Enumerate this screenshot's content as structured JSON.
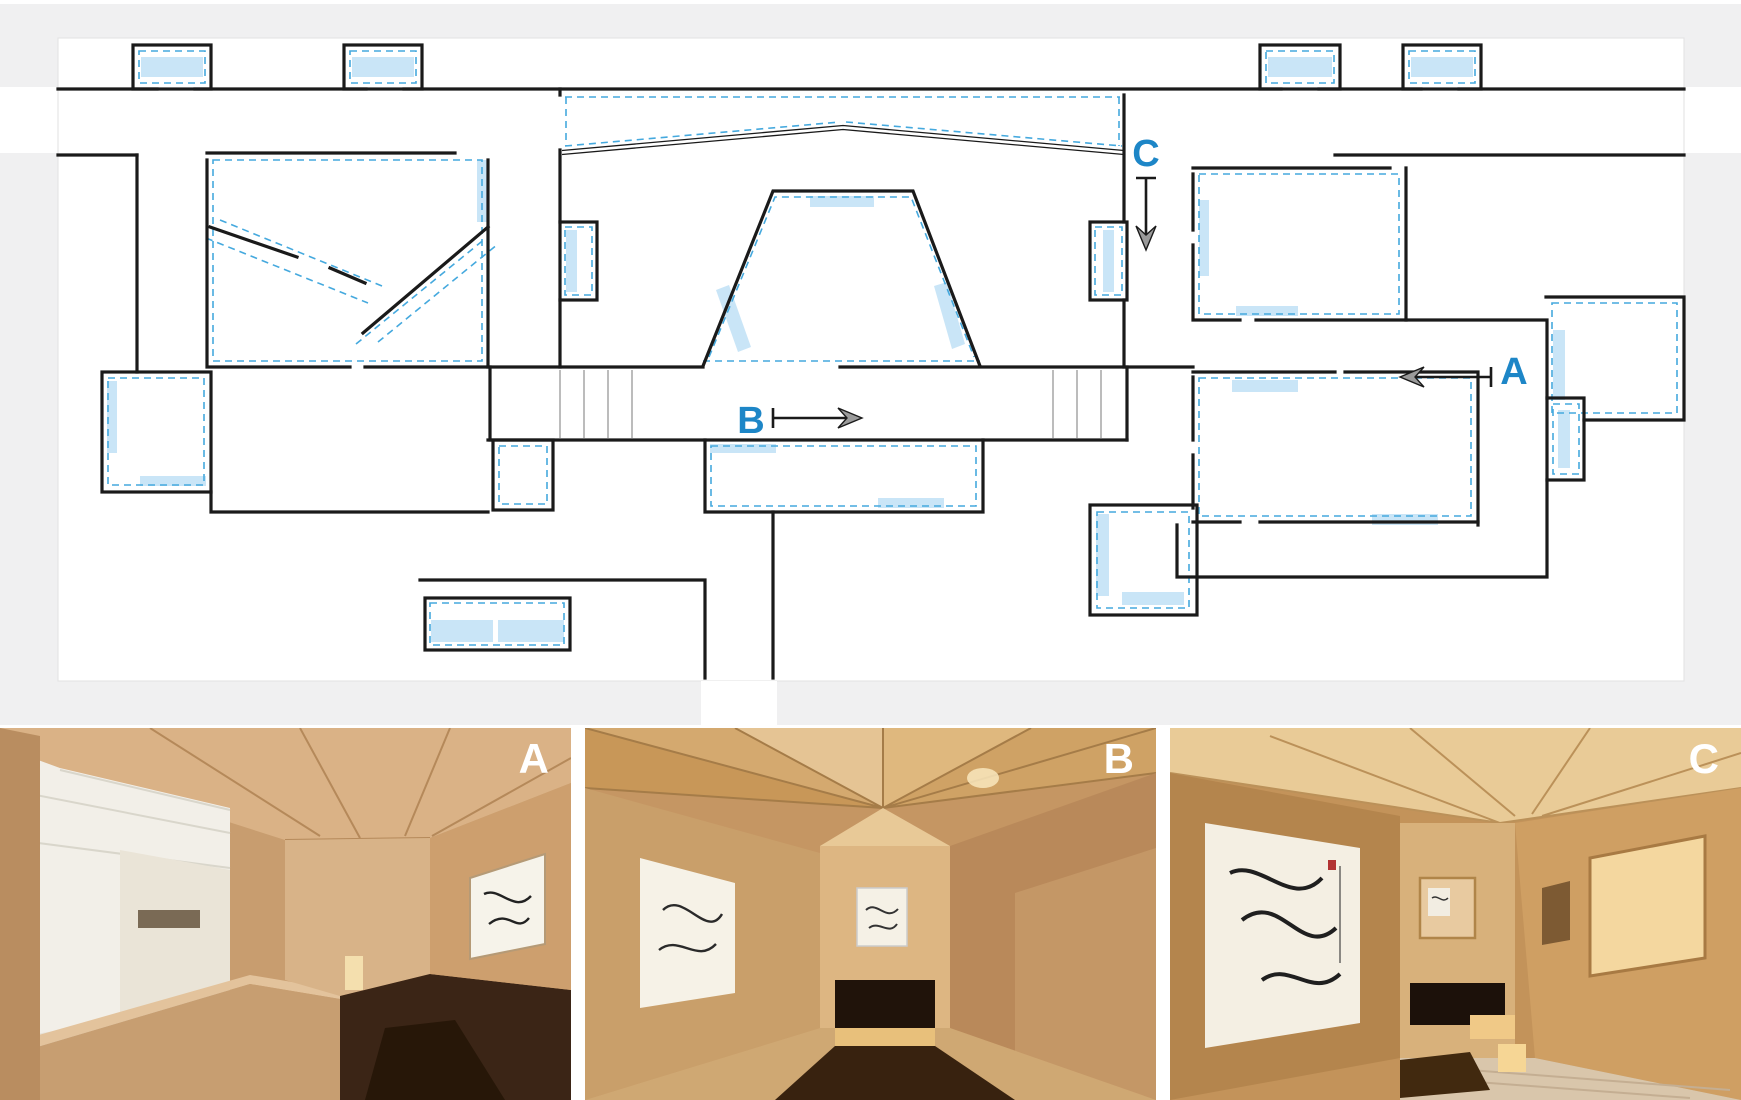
{
  "plan": {
    "section_markers": [
      {
        "id": "marker-c",
        "label": "C",
        "direction": "down"
      },
      {
        "id": "marker-a",
        "label": "A",
        "direction": "left"
      },
      {
        "id": "marker-b",
        "label": "B",
        "direction": "right"
      }
    ],
    "colors": {
      "margin_gray": "#f0f0f1",
      "canvas_white": "#ffffff",
      "wall_black": "#1a1a1a",
      "skylight_fill": "#c9e5f7",
      "skylight_dash_blue": "#45a9de",
      "marker_blue": "#1d86c7",
      "arrowhead_gray": "#9a9a9a"
    }
  },
  "photos": [
    {
      "label": "A",
      "caption_color": "#ffffff"
    },
    {
      "label": "B",
      "caption_color": "#ffffff"
    },
    {
      "label": "C",
      "caption_color": "#ffffff"
    }
  ]
}
